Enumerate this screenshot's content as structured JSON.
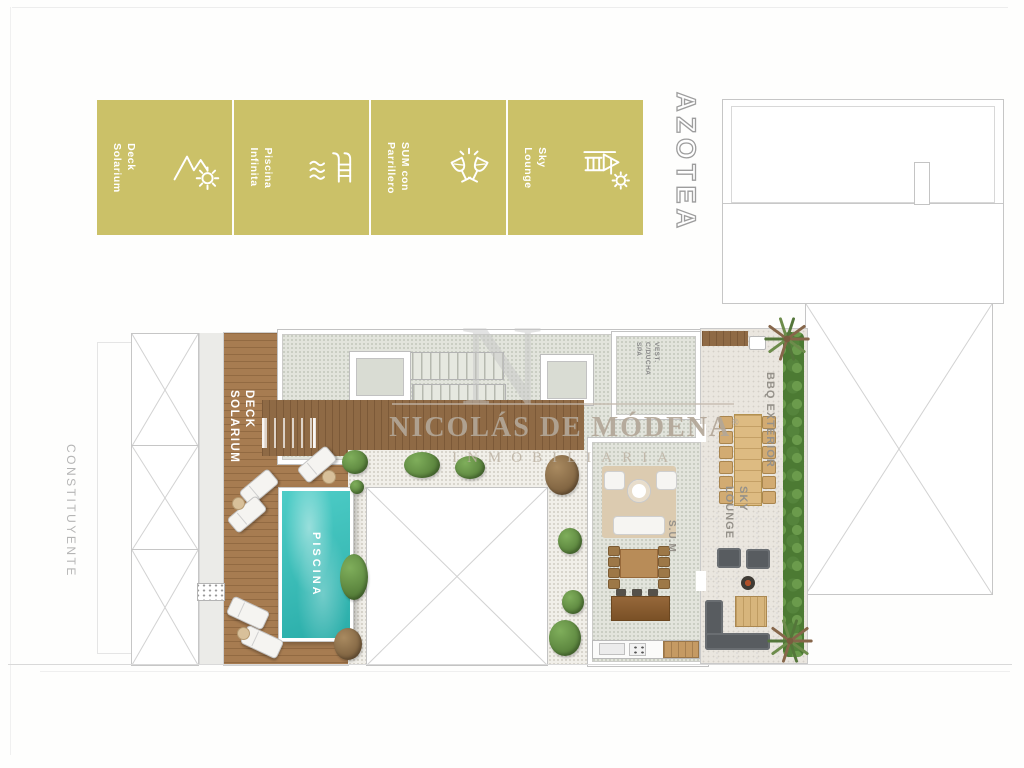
{
  "flyer": {
    "amenities": [
      {
        "icon": "mountains-sun-icon",
        "lines": [
          "Deck",
          "Solarium"
        ]
      },
      {
        "icon": "pool-ladder-icon",
        "lines": [
          "Piscina",
          "Infinita"
        ]
      },
      {
        "icon": "toasting-glasses-icon",
        "lines": [
          "SUM con",
          "Parrillero"
        ]
      },
      {
        "icon": "pergola-sun-icon",
        "lines": [
          "Sky",
          "Lounge"
        ]
      }
    ],
    "floor_label": "AZOTEA",
    "street_label": "CONSTITUYENTE",
    "watermark": {
      "monogram": "N",
      "name": "NICOLÁS DE MÓDENA",
      "registered": "®",
      "subtitle": "INMOBILIARIA"
    },
    "plan_labels": {
      "deck": [
        "DECK",
        "SOLARIUM"
      ],
      "pool": "PISCINA",
      "vest": [
        "VEST.",
        "C/DUCHA",
        "SPA"
      ],
      "sum": "S.U.M",
      "bbq": "BBQ EXTERIOR",
      "sky": [
        "SKY",
        "LOUNGE"
      ]
    },
    "colors": {
      "badge_gold": "#cbc168",
      "pool_water": "#3fc3be",
      "deck_wood": "#a57a50",
      "hedge_green": "#5d8c42",
      "label_gray": "#95918a",
      "watermark_tan": "#b2a697"
    }
  }
}
